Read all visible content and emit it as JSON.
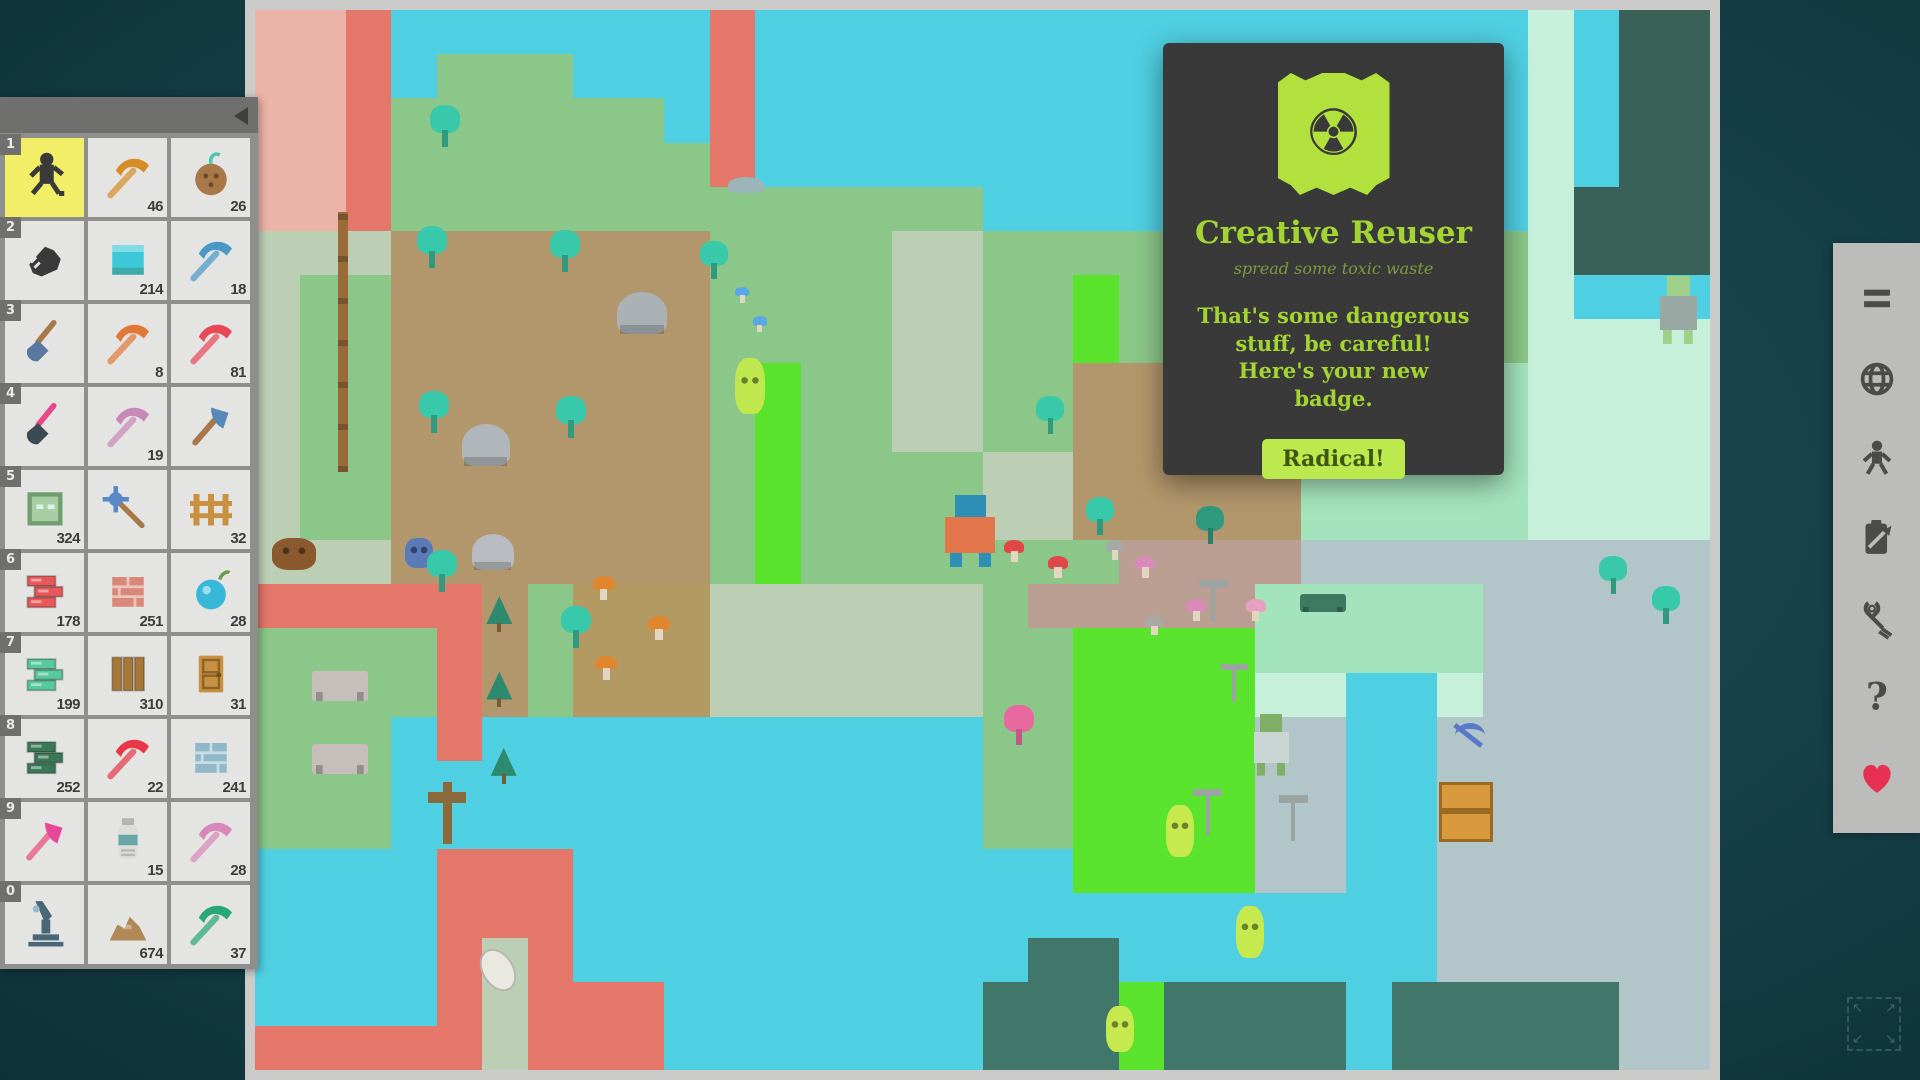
{
  "app": {
    "bg_color": "#153f47",
    "frame_color": "#cbcbc9"
  },
  "badge_popup": {
    "title": "Creative Reuser",
    "subtitle": "spread some toxic waste",
    "body": "That's some dangerous stuff, be careful! Here's your new badge.",
    "button_label": "Radical!",
    "accent_color": "#a3d431",
    "flag_color": "#b2e03c",
    "radiation_glyph": "☢"
  },
  "hotbar": {
    "rows": [
      {
        "key": "1",
        "items": [
          {
            "type": "runner",
            "color": "#3a3a3a",
            "count": "",
            "selected": true
          },
          {
            "type": "pickaxe",
            "color": "#d88c28",
            "count": "46"
          },
          {
            "type": "coconut",
            "color": "#a87848",
            "count": "26"
          }
        ]
      },
      {
        "key": "2",
        "items": [
          {
            "type": "hand",
            "color": "#3a3a3a",
            "count": ""
          },
          {
            "type": "waterblock",
            "color": "#3cc8d8",
            "count": "214"
          },
          {
            "type": "pickaxe",
            "color": "#4898c8",
            "count": "18"
          }
        ]
      },
      {
        "key": "3",
        "items": [
          {
            "type": "shovel",
            "color": "#5878a0",
            "color2": "#a87848",
            "count": ""
          },
          {
            "type": "pickaxe",
            "color": "#e07838",
            "count": "8"
          },
          {
            "type": "pickaxe",
            "color": "#e84858",
            "count": "81"
          }
        ]
      },
      {
        "key": "4",
        "items": [
          {
            "type": "shovel",
            "color": "#3a4a52",
            "color2": "#e84888",
            "count": ""
          },
          {
            "type": "pickaxe",
            "color": "#c888b8",
            "count": "19"
          },
          {
            "type": "axe",
            "color": "#5888b8",
            "color2": "#a87848",
            "count": ""
          }
        ]
      },
      {
        "key": "5",
        "items": [
          {
            "type": "block",
            "color": "#a8cfa4",
            "count": "324"
          },
          {
            "type": "mace",
            "color": "#5888c8",
            "color2": "#a87848",
            "count": ""
          },
          {
            "type": "fence",
            "color": "#c89040",
            "count": "32"
          }
        ]
      },
      {
        "key": "6",
        "items": [
          {
            "type": "bricks",
            "color": "#e85858",
            "count": "178"
          },
          {
            "type": "brickblock",
            "color": "#d88878",
            "count": "251"
          },
          {
            "type": "orb",
            "color": "#38b8d8",
            "count": "28"
          }
        ]
      },
      {
        "key": "7",
        "items": [
          {
            "type": "bricks",
            "color": "#58c8a0",
            "count": "199"
          },
          {
            "type": "planks",
            "color": "#a87838",
            "count": "310"
          },
          {
            "type": "door",
            "color": "#c89040",
            "count": "31"
          }
        ]
      },
      {
        "key": "8",
        "items": [
          {
            "type": "bricks",
            "color": "#3a7858",
            "count": "252"
          },
          {
            "type": "pickaxe",
            "color": "#e83848",
            "count": "22"
          },
          {
            "type": "brickblock",
            "color": "#90b8c8",
            "count": "241"
          }
        ]
      },
      {
        "key": "9",
        "items": [
          {
            "type": "axe",
            "color": "#e84898",
            "color2": "#e87898",
            "count": ""
          },
          {
            "type": "bottle",
            "color": "#68a8a8",
            "count": "15"
          },
          {
            "type": "pickaxe",
            "color": "#d888b8",
            "count": "28"
          }
        ]
      },
      {
        "key": "0",
        "items": [
          {
            "type": "microscope",
            "color": "#486878",
            "count": ""
          },
          {
            "type": "pile",
            "color": "#b08858",
            "count": "674"
          },
          {
            "type": "pickaxe",
            "color": "#28a878",
            "count": "37"
          }
        ]
      }
    ]
  },
  "toolbar": {
    "icons": [
      {
        "name": "menu-icon"
      },
      {
        "name": "globe-icon"
      },
      {
        "name": "player-icon"
      },
      {
        "name": "clipboard-icon"
      },
      {
        "name": "pliers-icon"
      },
      {
        "name": "help-icon",
        "glyph": "?"
      },
      {
        "name": "heart-icon",
        "color": "#e63054"
      }
    ],
    "fullscreen_arrows": [
      "↖",
      "↗",
      "↙",
      "↘"
    ]
  },
  "map": {
    "legend": {
      "O": {
        "color": "#ecb4a8",
        "pattern": "brick",
        "label": "pale-pink-brick"
      },
      "R": {
        "color": "#e4766a",
        "pattern": "brick",
        "label": "red-brick"
      },
      "W": {
        "color": "#4fd0e2",
        "pattern": "water",
        "label": "water"
      },
      "G": {
        "color": "#8bc789",
        "pattern": "grass",
        "label": "grass"
      },
      "P": {
        "color": "#bccfb4",
        "pattern": "none",
        "label": "path"
      },
      "p": {
        "color": "#bccfb4",
        "pattern": "dash",
        "label": "road-dashed"
      },
      "D": {
        "color": "#b3976c",
        "pattern": "grass",
        "label": "farm-dirt"
      },
      "o": {
        "color": "#b29a62",
        "pattern": "grass",
        "label": "mushroom-dirt"
      },
      "n": {
        "color": "#bb9e92",
        "pattern": "grass",
        "label": "pink-dirt"
      },
      "L": {
        "color": "#5ae32d",
        "pattern": "grass",
        "label": "toxic-grass"
      },
      "M": {
        "color": "#a4e4bc",
        "pattern": "grass",
        "label": "mint-lawn"
      },
      "m": {
        "color": "#c6f0da",
        "pattern": "checker",
        "label": "mint-checker"
      },
      "T": {
        "color": "#41776a",
        "pattern": "brick",
        "label": "teal-brick"
      },
      "S": {
        "color": "#b2c6ca",
        "pattern": "brick",
        "label": "stone-pavement"
      },
      "K": {
        "color": "#3a6157",
        "pattern": "brick",
        "label": "dark-brick"
      },
      "F": {
        "color": "#b3976c",
        "pattern": "grass",
        "label": "pine-dirt"
      }
    },
    "tiles": [
      "OORWWWWWWWRWWWWWWWWWWWWWWWWWmWKK",
      "OORWGGGWWWRWWWWWWWWWWWWWWWWWmWKK",
      "OORGGGGGGWRWWWWWWWWWWWWWWWWWmWKK",
      "OORGGGGGGGRWWWWWWWWWWWWWWWWWmWKK",
      "OORGGGGGGGGGGGGGWWWWWWWWWWWWmKKK",
      "pppDDDDDDDGGGGppGGGGGGGGGGGGmKKK",
      "pGGDDDDDDDGGGGppGGLGGGGGGGGGmWWW",
      "pGGDDDDDDDGGGGppGGLGGGGGGGGGmmmm",
      "pGGDDDDDDDGLGGppGGDDDDDMMMMMmmmm",
      "pGGDDDDDDDGLGGppGGDDDDDMMMMMmmmm",
      "pGGDDDDDDDGLGGGGppDDDDDMMMMMmmmm",
      "pGGDDDDDDDGLGGGGppDDDDDMMMMMmmmm",
      "PPPDDDDDDDGLGGGGdddnnnnSSSSSSSSS",
      "RRRRRFGoooPPPPPPGnnnnnMMMMMSSSSS",
      "GGGGRFGoooPPPPPPGGLLLLMMMMMSSSSS",
      "GGGGRFGoooppppppGGLLLLmmWWmSSSSS",
      "GGGWRWWWWWWWWWWWGGLLLLSSWWSSSSSS",
      "GGGWWWWWWWWWWWWWGGLLLLSSWWSSSSSS",
      "GGGWWWWWWWWWWWWWGGLLLLSSWWSSSSSS",
      "WWWWRRRWWWWWWWWWWWLLLLSSWWSSSSSS",
      "WWWWRRRWWWWWWWWWWWWWWWWWWWSSSSSS",
      "WWWWRPRWWWWWWWWWWTTWWWWWWWSSSSSS",
      "WWWWRPRRRWWWWWWWTTTLTTTTWTTTTTSS",
      "RRRRRPRRRWWWWWWWTTTLTTTTWTTTTTSS"
    ],
    "sprites": [
      {
        "name": "player",
        "type": "human",
        "x": 47.1,
        "y": 45.8,
        "w": 60,
        "h": 72,
        "c1": "#e2764a",
        "c2": "#2d8fb5"
      },
      {
        "name": "lime-ghost",
        "type": "blob",
        "x": 33.0,
        "y": 32.8,
        "w": 30,
        "h": 56,
        "c1": "#bfe84e"
      },
      {
        "name": "alien",
        "type": "human",
        "x": 96.3,
        "y": 25.1,
        "w": 44,
        "h": 68,
        "c1": "#9aa8a4",
        "c2": "#9ed08a"
      },
      {
        "name": "nun",
        "type": "human",
        "x": 68.4,
        "y": 66.4,
        "w": 42,
        "h": 62,
        "c1": "#c9d6d4",
        "c2": "#7fae66"
      },
      {
        "name": "slime",
        "type": "blob",
        "x": 62.6,
        "y": 75.0,
        "w": 28,
        "h": 52,
        "c1": "#c6e94e"
      },
      {
        "name": "slime",
        "type": "blob",
        "x": 67.4,
        "y": 84.5,
        "w": 28,
        "h": 52,
        "c1": "#c6e94e"
      },
      {
        "name": "slime",
        "type": "blob",
        "x": 58.5,
        "y": 94.0,
        "w": 28,
        "h": 46,
        "c1": "#c6e94e"
      },
      {
        "name": "bear",
        "type": "blob",
        "x": 1.2,
        "y": 49.8,
        "w": 44,
        "h": 32,
        "c1": "#8a5a2e"
      },
      {
        "name": "robot",
        "type": "blob",
        "x": 10.3,
        "y": 49.8,
        "w": 28,
        "h": 30,
        "c1": "#5a7ab8"
      },
      {
        "name": "jellyfish",
        "type": "ufo",
        "x": 14.9,
        "y": 49.4,
        "w": 42,
        "h": 36,
        "c1": "#b8bcc0"
      },
      {
        "name": "ufo",
        "type": "ufo",
        "x": 24.9,
        "y": 26.6,
        "w": 50,
        "h": 42,
        "c1": "#aab2b6"
      },
      {
        "name": "ufo",
        "type": "ufo",
        "x": 14.2,
        "y": 39.1,
        "w": 48,
        "h": 42,
        "c1": "#b0b6ba"
      },
      {
        "name": "picnic-table",
        "type": "table",
        "x": 3.9,
        "y": 62.4,
        "w": 56,
        "h": 30,
        "c1": "#c6beba"
      },
      {
        "name": "picnic-table",
        "type": "table",
        "x": 3.9,
        "y": 69.2,
        "w": 56,
        "h": 30,
        "c1": "#c6beba"
      },
      {
        "name": "bench",
        "type": "table",
        "x": 71.8,
        "y": 55.1,
        "w": 46,
        "h": 18,
        "c1": "#3e7a62"
      },
      {
        "name": "crate",
        "type": "crate",
        "x": 81.4,
        "y": 72.8,
        "w": 54,
        "h": 60,
        "c1": "#d89a3c"
      },
      {
        "name": "dropped-pickaxe",
        "type": "pick",
        "x": 82.1,
        "y": 67.1,
        "w": 40,
        "h": 34,
        "c1": "#5878c8"
      },
      {
        "name": "pole",
        "type": "pole",
        "x": 5.7,
        "y": 19.1,
        "w": 10,
        "h": 260,
        "c1": "#9a6a38"
      },
      {
        "name": "grave-cross",
        "type": "cross",
        "x": 11.9,
        "y": 72.8,
        "w": 38,
        "h": 62,
        "c1": "#8a6a3a"
      },
      {
        "name": "footprint",
        "type": "shoe",
        "x": 15.6,
        "y": 88.4,
        "w": 32,
        "h": 46,
        "c1": "#eceae4"
      },
      {
        "name": "bird",
        "type": "bird",
        "x": 32.5,
        "y": 15.8,
        "w": 36,
        "h": 16,
        "c1": "#9ab4b8"
      },
      {
        "name": "windmill",
        "type": "windmill",
        "x": 64.7,
        "y": 53.8,
        "w": 34,
        "h": 42,
        "c1": "#9aa4a0"
      },
      {
        "name": "windmill",
        "type": "windmill",
        "x": 66.2,
        "y": 61.7,
        "w": 32,
        "h": 38,
        "c1": "#9aa4a0"
      },
      {
        "name": "windmill",
        "type": "windmill",
        "x": 64.3,
        "y": 73.5,
        "w": 34,
        "h": 46,
        "c1": "#9aa4a0"
      },
      {
        "name": "windmill",
        "type": "windmill",
        "x": 70.2,
        "y": 74.1,
        "w": 34,
        "h": 46,
        "c1": "#9aa4a0"
      },
      {
        "name": "tree",
        "type": "tree",
        "x": 12.0,
        "y": 9.0,
        "w": 30,
        "h": 42,
        "c1": "#38c8aa",
        "c2": "#2f9a7e"
      },
      {
        "name": "tree",
        "type": "tree",
        "x": 11.1,
        "y": 20.4,
        "w": 30,
        "h": 42,
        "c1": "#38c8aa",
        "c2": "#2f9a7e"
      },
      {
        "name": "tree",
        "type": "tree",
        "x": 20.3,
        "y": 20.8,
        "w": 30,
        "h": 42,
        "c1": "#38c8aa",
        "c2": "#2f9a7e"
      },
      {
        "name": "tree",
        "type": "tree",
        "x": 11.3,
        "y": 35.9,
        "w": 30,
        "h": 42,
        "c1": "#38c8aa",
        "c2": "#2f9a7e"
      },
      {
        "name": "tree",
        "type": "tree",
        "x": 20.7,
        "y": 36.4,
        "w": 30,
        "h": 42,
        "c1": "#38c8aa",
        "c2": "#2f9a7e"
      },
      {
        "name": "tree",
        "type": "tree",
        "x": 11.8,
        "y": 50.9,
        "w": 30,
        "h": 42,
        "c1": "#38c8aa",
        "c2": "#2f9a7e"
      },
      {
        "name": "tree",
        "type": "tree",
        "x": 21.0,
        "y": 56.2,
        "w": 30,
        "h": 42,
        "c1": "#38c8aa",
        "c2": "#2f9a7e"
      },
      {
        "name": "tree",
        "type": "tree",
        "x": 30.6,
        "y": 21.8,
        "w": 28,
        "h": 38,
        "c1": "#38c8aa",
        "c2": "#2f9a7e"
      },
      {
        "name": "tree",
        "type": "tree",
        "x": 53.7,
        "y": 36.4,
        "w": 28,
        "h": 38,
        "c1": "#38c8aa",
        "c2": "#2f9a7e"
      },
      {
        "name": "tree",
        "type": "tree",
        "x": 63.3,
        "y": 38.3,
        "w": 28,
        "h": 38,
        "c1": "#2f9a7e",
        "c2": "#27806a"
      },
      {
        "name": "tree",
        "type": "tree",
        "x": 57.1,
        "y": 45.9,
        "w": 28,
        "h": 38,
        "c1": "#38c8aa",
        "c2": "#2f9a7e"
      },
      {
        "name": "tree",
        "type": "tree",
        "x": 64.7,
        "y": 46.8,
        "w": 28,
        "h": 38,
        "c1": "#2f9a7e",
        "c2": "#27806a"
      },
      {
        "name": "tree",
        "type": "tree",
        "x": 92.4,
        "y": 51.5,
        "w": 28,
        "h": 38,
        "c1": "#38c8aa",
        "c2": "#2f9a7e"
      },
      {
        "name": "tree",
        "type": "tree",
        "x": 96.0,
        "y": 54.3,
        "w": 28,
        "h": 38,
        "c1": "#38c8aa",
        "c2": "#2f9a7e"
      },
      {
        "name": "pink-tree",
        "type": "tree",
        "x": 51.5,
        "y": 65.6,
        "w": 30,
        "h": 40,
        "c1": "#e868a0",
        "c2": "#c05888"
      },
      {
        "name": "pine",
        "type": "pine",
        "x": 15.9,
        "y": 55.3,
        "w": 26,
        "h": 36,
        "c1": "#2e8a6e",
        "c2": "#7a5a34"
      },
      {
        "name": "pine",
        "type": "pine",
        "x": 15.9,
        "y": 62.4,
        "w": 26,
        "h": 36,
        "c1": "#2e8a6e",
        "c2": "#7a5a34"
      },
      {
        "name": "pine",
        "type": "pine",
        "x": 16.2,
        "y": 69.6,
        "w": 26,
        "h": 36,
        "c1": "#2e8a6e",
        "c2": "#7a5a34"
      },
      {
        "name": "orange-mushroom",
        "type": "mushroom",
        "x": 23.2,
        "y": 53.4,
        "w": 22,
        "h": 24,
        "c1": "#e0862e"
      },
      {
        "name": "orange-mushroom",
        "type": "mushroom",
        "x": 27.0,
        "y": 57.2,
        "w": 22,
        "h": 24,
        "c1": "#e0862e"
      },
      {
        "name": "orange-mushroom",
        "type": "mushroom",
        "x": 23.4,
        "y": 60.9,
        "w": 22,
        "h": 24,
        "c1": "#e0862e"
      },
      {
        "name": "red-mushroom",
        "type": "mushroom",
        "x": 51.5,
        "y": 50.0,
        "w": 20,
        "h": 22,
        "c1": "#e04848"
      },
      {
        "name": "red-mushroom",
        "type": "mushroom",
        "x": 54.5,
        "y": 51.5,
        "w": 20,
        "h": 22,
        "c1": "#e04848"
      },
      {
        "name": "pink-mushroom",
        "type": "mushroom",
        "x": 60.5,
        "y": 51.5,
        "w": 20,
        "h": 22,
        "c1": "#d88ab8"
      },
      {
        "name": "pink-mushroom",
        "type": "mushroom",
        "x": 64.0,
        "y": 55.6,
        "w": 20,
        "h": 22,
        "c1": "#d88ab8"
      },
      {
        "name": "gray-mushroom",
        "type": "mushroom",
        "x": 61.2,
        "y": 57.1,
        "w": 18,
        "h": 20,
        "c1": "#a8a8a4"
      },
      {
        "name": "gray-mushroom",
        "type": "mushroom",
        "x": 58.5,
        "y": 50.0,
        "w": 18,
        "h": 20,
        "c1": "#a8a8a4"
      },
      {
        "name": "flower-table",
        "type": "mushroom",
        "x": 68.1,
        "y": 55.6,
        "w": 20,
        "h": 22,
        "c1": "#e8a0c0"
      },
      {
        "name": "blue-gem",
        "type": "mushroom",
        "x": 33.0,
        "y": 26.1,
        "w": 14,
        "h": 16,
        "c1": "#58a8e8"
      },
      {
        "name": "blue-gem",
        "type": "mushroom",
        "x": 34.2,
        "y": 28.9,
        "w": 14,
        "h": 16,
        "c1": "#58a8e8"
      }
    ]
  }
}
